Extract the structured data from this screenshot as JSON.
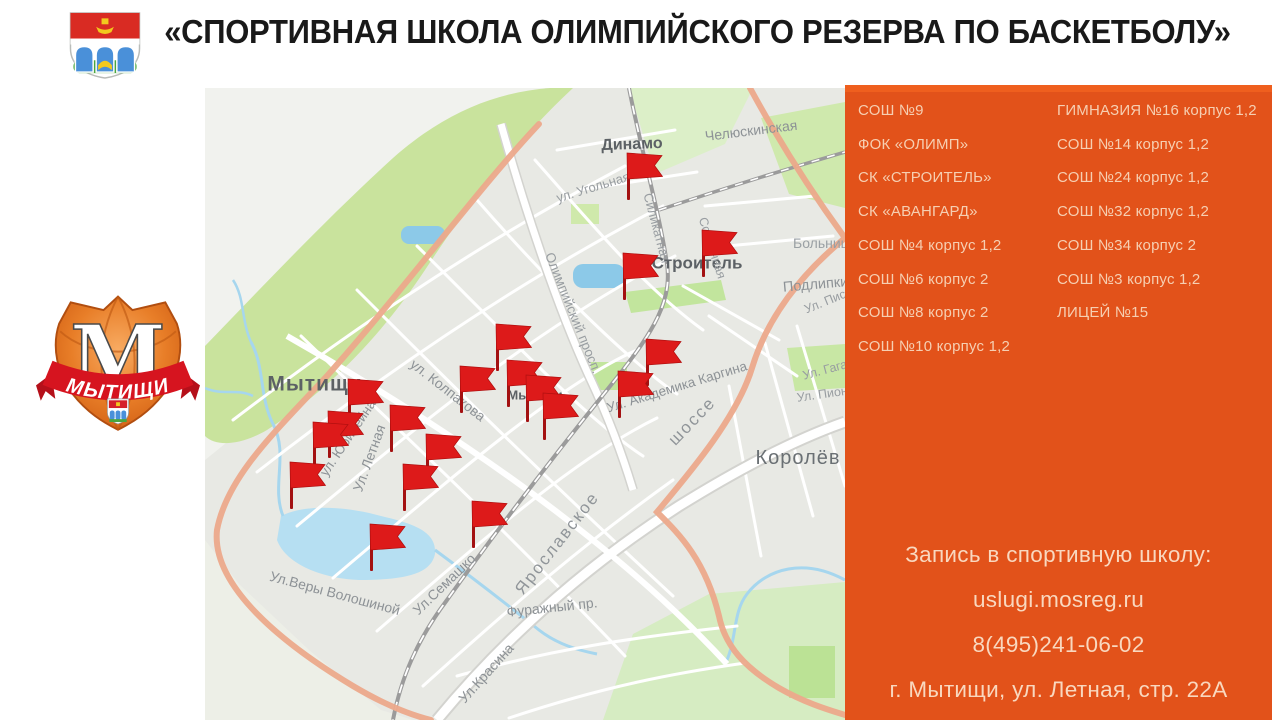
{
  "slide": {
    "title": "«СПОРТИВНАЯ ШКОЛА ОЛИМПИЙСКОГО РЕЗЕРВА ПО БАСКЕТБОЛУ»"
  },
  "logo": {
    "letter": "М",
    "city": "МЫТИЩИ"
  },
  "panel": {
    "bg": "#e2521a",
    "top_strip": "#ef5f1e",
    "list_text_color": "#f6cfb2",
    "contact_text_color": "#f9d8bf",
    "schools_col1": [
      "СОШ №9",
      "ФОК «ОЛИМП»",
      "СК «СТРОИТЕЛЬ»",
      "СК «АВАНГАРД»",
      "СОШ №4 корпус 1,2",
      "СОШ №6 корпус 2",
      "СОШ №8 корпус 2",
      "СОШ №10 корпус 1,2"
    ],
    "schools_col2": [
      "ГИМНАЗИЯ №16 корпус 1,2",
      "СОШ №14 корпус 1,2",
      "СОШ №24 корпус 1,2",
      "СОШ №32 корпус 1,2",
      "СОШ №34 корпус 2",
      "СОШ №3 корпус 1,2",
      "ЛИЦЕЙ №15"
    ],
    "contact": [
      "Запись в спортивную школу:",
      "uslugi.mosreg.ru",
      "8(495)241-06-02",
      "г. Мытищи, ул. Летная, стр. 22А"
    ]
  },
  "map": {
    "flag_color": "#dd1a1a",
    "place_labels": [
      {
        "text": "Динамо",
        "x": 427,
        "y": 57,
        "rot": -2,
        "size": 16,
        "w": 700,
        "c": "#5c6165"
      },
      {
        "text": "Челюскинская",
        "x": 500,
        "y": 48,
        "rot": -7,
        "size": 14,
        "w": 400,
        "c": "#8d9296",
        "anchor": "left"
      },
      {
        "text": "ул. Угольная",
        "x": 388,
        "y": 99,
        "rot": -17,
        "size": 13,
        "w": 400,
        "c": "#989da1"
      },
      {
        "text": "Силикатная",
        "x": 452,
        "y": 140,
        "rot": 75,
        "size": 13,
        "w": 400,
        "c": "#989da1"
      },
      {
        "text": "Строитель",
        "x": 492,
        "y": 175,
        "rot": 0,
        "size": 17,
        "w": 700,
        "c": "#5c6165"
      },
      {
        "text": "Солнечная",
        "x": 507,
        "y": 160,
        "rot": 72,
        "size": 12.5,
        "w": 400,
        "c": "#989da1"
      },
      {
        "text": "Больница",
        "x": 588,
        "y": 155,
        "rot": 0,
        "size": 14,
        "w": 400,
        "c": "#9aa0a4",
        "anchor": "left"
      },
      {
        "text": "Подлипки",
        "x": 578,
        "y": 200,
        "rot": -5,
        "size": 14.5,
        "w": 400,
        "c": "#8d9296",
        "anchor": "left"
      },
      {
        "text": "Ул. Писарева",
        "x": 600,
        "y": 222,
        "rot": -22,
        "size": 12.5,
        "w": 400,
        "c": "#989da1",
        "anchor": "left"
      },
      {
        "text": "Ул. Гагарина",
        "x": 598,
        "y": 288,
        "rot": -15,
        "size": 12.5,
        "w": 400,
        "c": "#989da1",
        "anchor": "left"
      },
      {
        "text": "Ул. Пионерская",
        "x": 592,
        "y": 310,
        "rot": -8,
        "size": 12.5,
        "w": 400,
        "c": "#989da1",
        "anchor": "left"
      },
      {
        "text": "Олимпийский просп.",
        "x": 368,
        "y": 225,
        "rot": 68,
        "size": 13.5,
        "w": 400,
        "c": "#989da1"
      },
      {
        "text": "ул. Колпакова",
        "x": 243,
        "y": 302,
        "rot": 38,
        "size": 14,
        "w": 400,
        "c": "#8d9296"
      },
      {
        "text": "Мытищи",
        "x": 110,
        "y": 296,
        "rot": 0,
        "size": 21,
        "w": 700,
        "c": "#5c6165",
        "ls": 1
      },
      {
        "text": "Мытищи",
        "x": 330,
        "y": 307,
        "rot": 0,
        "size": 13,
        "w": 700,
        "c": "#5c6165"
      },
      {
        "text": "ул. Юбилейная",
        "x": 145,
        "y": 347,
        "rot": -56,
        "size": 13.5,
        "w": 400,
        "c": "#8d9296"
      },
      {
        "text": "Ул. Летная",
        "x": 164,
        "y": 370,
        "rot": -70,
        "size": 14,
        "w": 400,
        "c": "#8d9296"
      },
      {
        "text": "Ул. Академика Каргина",
        "x": 472,
        "y": 299,
        "rot": -17,
        "size": 13.5,
        "w": 400,
        "c": "#8d9296"
      },
      {
        "text": "Ярославское",
        "x": 352,
        "y": 455,
        "rot": -52,
        "size": 17,
        "w": 400,
        "c": "#909599",
        "ls": 2
      },
      {
        "text": "шоссе",
        "x": 487,
        "y": 333,
        "rot": -46,
        "size": 17,
        "w": 400,
        "c": "#909599",
        "ls": 2
      },
      {
        "text": "Королёв",
        "x": 593,
        "y": 370,
        "rot": 0,
        "size": 20,
        "w": 400,
        "c": "#6a7074",
        "ls": 1
      },
      {
        "text": "Ул.Веры Волошиной",
        "x": 130,
        "y": 505,
        "rot": 15,
        "size": 14,
        "w": 400,
        "c": "#8d9296"
      },
      {
        "text": "Ул.Семашко",
        "x": 239,
        "y": 496,
        "rot": -44,
        "size": 14,
        "w": 400,
        "c": "#8d9296"
      },
      {
        "text": "Фуражный пр.",
        "x": 347,
        "y": 519,
        "rot": -6,
        "size": 14,
        "w": 400,
        "c": "#8d9296"
      },
      {
        "text": "Ул.Красина",
        "x": 281,
        "y": 585,
        "rot": -48,
        "size": 14,
        "w": 400,
        "c": "#8d9296"
      }
    ],
    "flags": [
      {
        "x": 439,
        "y": 78
      },
      {
        "x": 514,
        "y": 155
      },
      {
        "x": 435,
        "y": 178
      },
      {
        "x": 308,
        "y": 249
      },
      {
        "x": 458,
        "y": 264
      },
      {
        "x": 319,
        "y": 285
      },
      {
        "x": 338,
        "y": 300
      },
      {
        "x": 272,
        "y": 291
      },
      {
        "x": 430,
        "y": 296
      },
      {
        "x": 355,
        "y": 318
      },
      {
        "x": 160,
        "y": 304
      },
      {
        "x": 202,
        "y": 330
      },
      {
        "x": 140,
        "y": 336
      },
      {
        "x": 125,
        "y": 347
      },
      {
        "x": 238,
        "y": 359
      },
      {
        "x": 102,
        "y": 387
      },
      {
        "x": 215,
        "y": 389
      },
      {
        "x": 284,
        "y": 426
      },
      {
        "x": 182,
        "y": 449
      }
    ]
  }
}
